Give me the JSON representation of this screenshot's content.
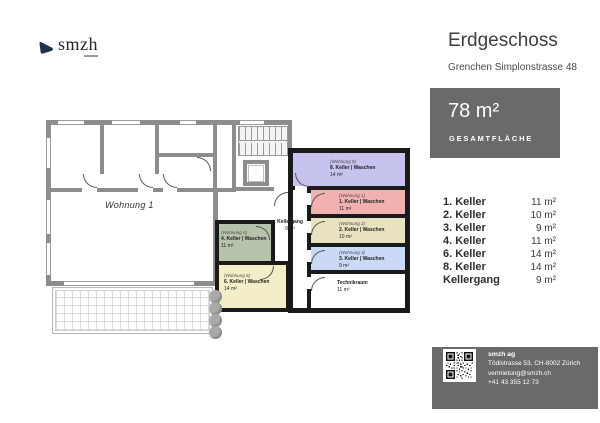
{
  "logo": {
    "text": "smzh"
  },
  "header": {
    "title": "Erdgeschoss",
    "subtitle": "Grenchen Simplonstrasse 48"
  },
  "area_box": {
    "value": "78 m²",
    "label": "GESAMTFLÄCHE"
  },
  "room_list": [
    {
      "name": "1. Keller",
      "area": "11 m²"
    },
    {
      "name": "2. Keller",
      "area": "10 m²"
    },
    {
      "name": "3. Keller",
      "area": "9 m²"
    },
    {
      "name": "4. Keller",
      "area": "11 m²"
    },
    {
      "name": "6. Keller",
      "area": "14 m²"
    },
    {
      "name": "8. Keller",
      "area": "14 m²"
    },
    {
      "name": "Kellergang",
      "area": "9 m²"
    }
  ],
  "contact": {
    "company": "smzh ag",
    "address": "Tödistrasse 53, CH-8002 Zürich",
    "email": "vermietung@smzh.ch",
    "phone": "+41 43 355 12 73"
  },
  "plan": {
    "apartment_label": "Wohnung 1",
    "corridor": {
      "name": "Kellergang",
      "area": "9 m²"
    },
    "technik_room": {
      "name": "Technikraum",
      "area": "11 m²"
    },
    "cellar_rooms": [
      {
        "wohnung": "(Wohnung 8)",
        "name": "8. Keller | Waschen",
        "area": "14 m²",
        "color": "#c6c4ef"
      },
      {
        "wohnung": "(Wohnung 1)",
        "name": "1. Keller | Waschen",
        "area": "11 m²",
        "color": "#f1b1b1"
      },
      {
        "wohnung": "(Wohnung 2)",
        "name": "2. Keller | Waschen",
        "area": "10 m²",
        "color": "#e8e2c0"
      },
      {
        "wohnung": "(Wohnung 3)",
        "name": "3. Keller | Waschen",
        "area": "9 m²",
        "color": "#c9d9f6"
      },
      {
        "wohnung": "(Wohnung 5)",
        "name": "4. Keller | Waschen",
        "area": "11 m²",
        "color": "#b7c2ab"
      },
      {
        "wohnung": "(Wohnung 6)",
        "name": "6. Keller | Waschen",
        "area": "14 m²",
        "color": "#f4eec8"
      }
    ]
  },
  "colors": {
    "accent_gray": "#6a6a6a",
    "wall_gray": "#8d8d8d",
    "wall_black": "#1a1a1a",
    "logo_navy": "#25304d"
  }
}
